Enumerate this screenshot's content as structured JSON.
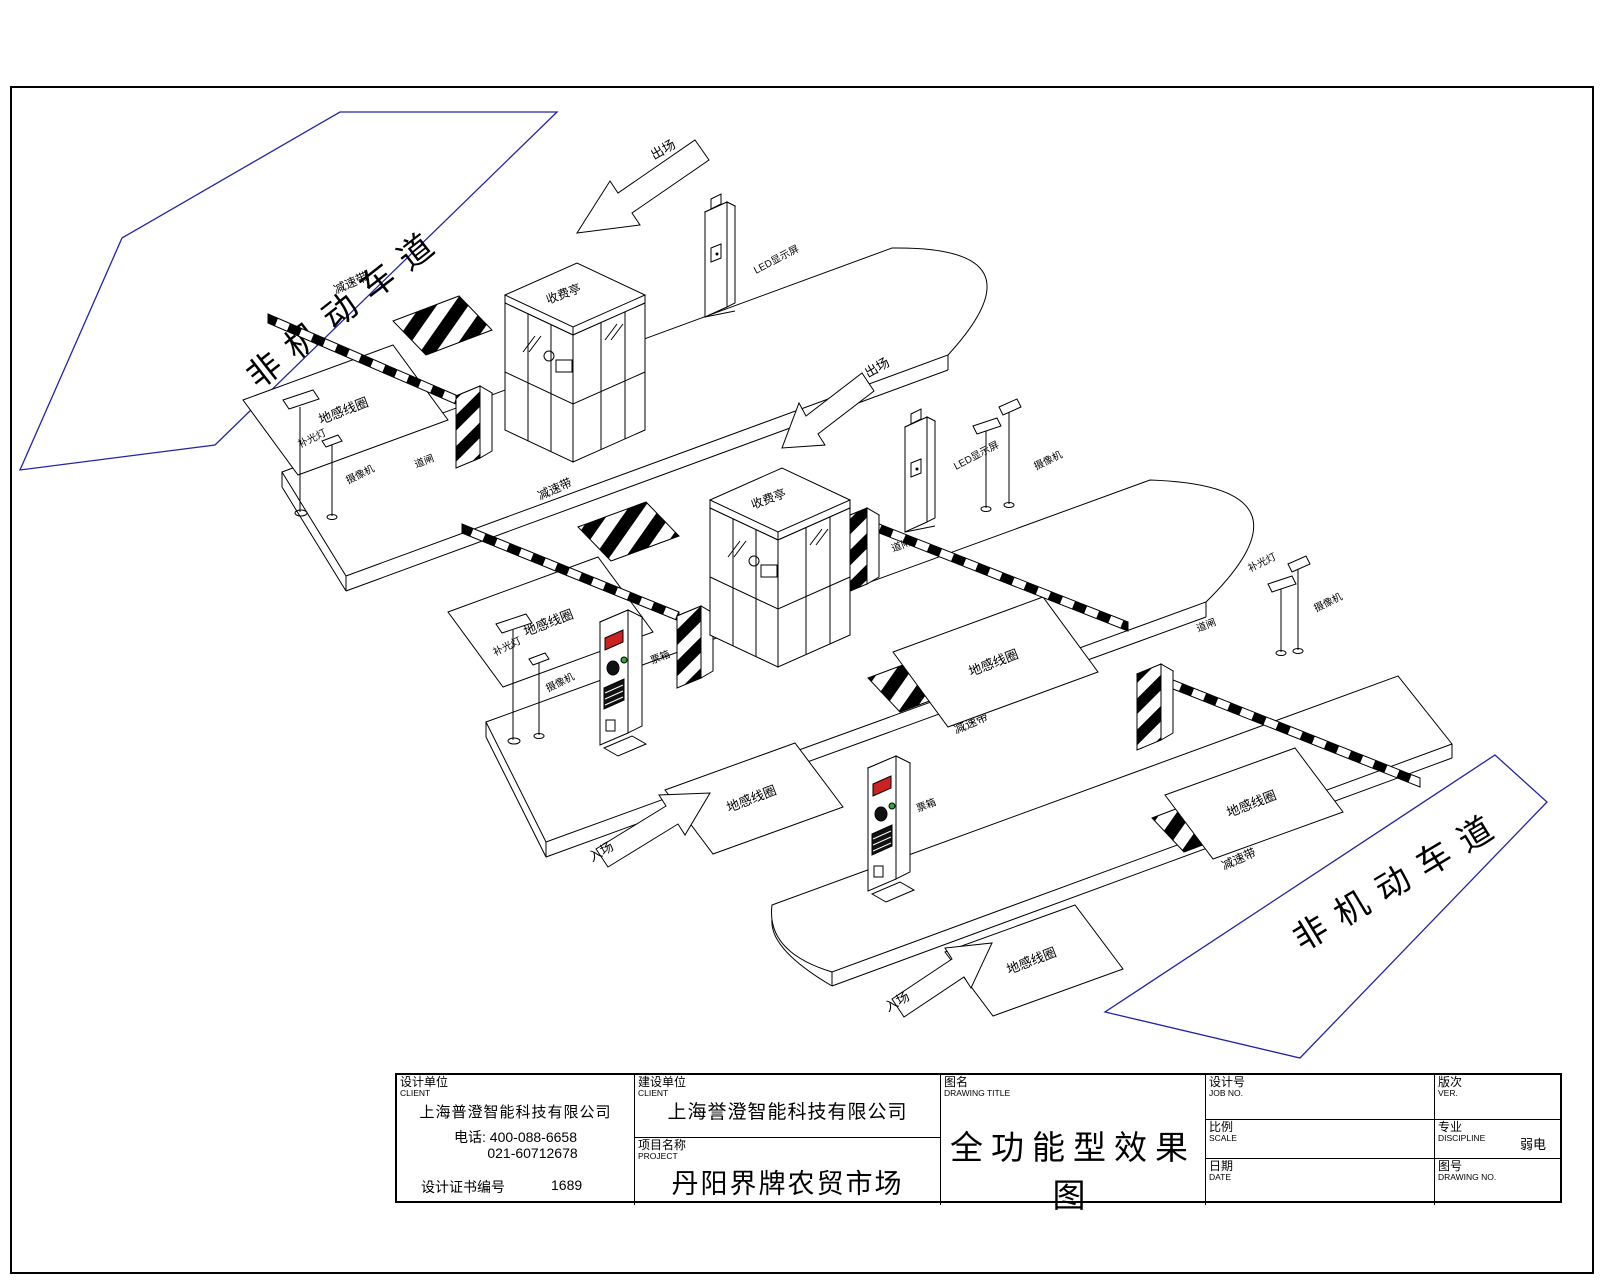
{
  "sheet": {
    "zones": {
      "non_motor_lane": "非机动车道"
    },
    "labels": {
      "speed_bump": "减速带",
      "ground_coil": "地感线圈",
      "booth": "收费亭",
      "exit_arrow": "出场",
      "entrance_arrow": "入场",
      "camera": "摄像机",
      "fill_light": "补光灯",
      "led_display": "LED显示屏",
      "barrier_gate": "道闸",
      "ticket_box": "票箱"
    },
    "colors": {
      "zone_blue": "#2323aa",
      "display_red": "#cc2222",
      "button_green": "#2faa2f",
      "line": "#000000"
    }
  },
  "title_block": {
    "design_unit": {
      "zh": "设计单位",
      "en": "CLIENT",
      "company": "上海普澄智能科技有限公司",
      "phone1": "电话: 400-088-6658",
      "phone2": "021-60712678",
      "cert_label": "设计证书编号",
      "cert_no": "1689"
    },
    "build_unit": {
      "zh": "建设单位",
      "en": "CLIENT",
      "company": "上海誉澄智能科技有限公司"
    },
    "project": {
      "zh": "项目名称",
      "en": "PROJECT",
      "name": "丹阳界牌农贸市场"
    },
    "drawing_title": {
      "zh": "图名",
      "en": "DRAWING TITLE",
      "title": "全功能型效果图"
    },
    "job_no": {
      "zh": "设计号",
      "en": "JOB NO.",
      "value": ""
    },
    "version": {
      "zh": "版次",
      "en": "VER.",
      "value": ""
    },
    "scale": {
      "zh": "比例",
      "en": "SCALE",
      "value": ""
    },
    "discipline": {
      "zh": "专业",
      "en": "DISCIPLINE",
      "value": "弱电"
    },
    "date": {
      "zh": "日期",
      "en": "DATE",
      "value": ""
    },
    "drawing_no": {
      "zh": "图号",
      "en": "DRAWING NO.",
      "value": ""
    }
  }
}
